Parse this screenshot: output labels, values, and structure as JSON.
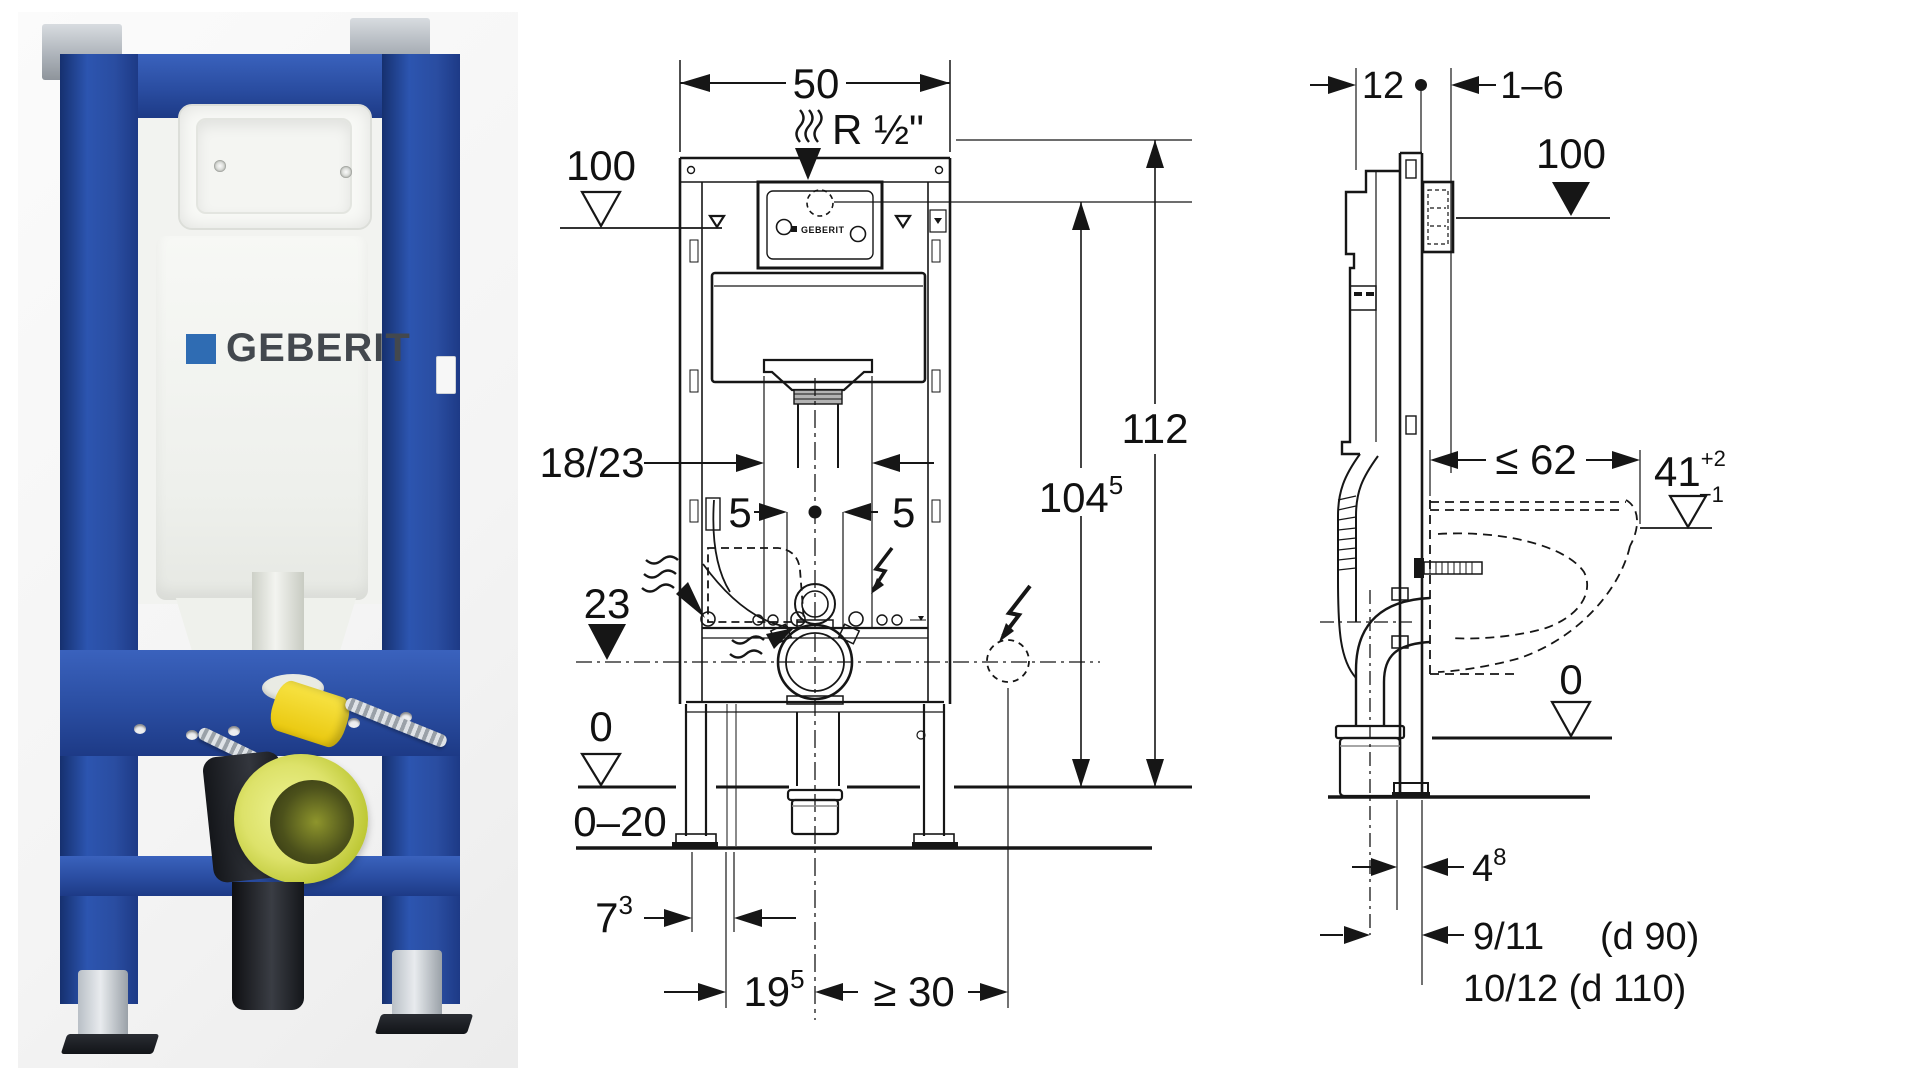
{
  "photo": {
    "brand": "GEBERIT",
    "frame_color": "#2a4da1",
    "cistern_color": "#f2f3f0",
    "drain_yellow": "#e8d832",
    "elbow_lime": "#d6de5e",
    "logo_blue": "#2f6cb3"
  },
  "front_view": {
    "top_width": "50",
    "supply": "R ½\"",
    "plate_level": "100",
    "height_total": "112",
    "actuation": {
      "base": "104",
      "sup": "5"
    },
    "bend": "18/23",
    "offset_left": "5",
    "offset_right": "5",
    "outlet_height": "23",
    "finished_floor": "0",
    "floor_buildup": "0–20",
    "dim73": {
      "base": "7",
      "sup": "3"
    },
    "dim195": {
      "base": "19",
      "sup": "5"
    },
    "clearance": "≥ 30",
    "plate_brand": "GEBERIT"
  },
  "side_view": {
    "frame_depth": "12",
    "wall_gap": "1–6",
    "plate_level": "100",
    "bowl_depth": "≤ 62",
    "rim": {
      "base": "41",
      "tol_plus": "+2",
      "tol_minus": "−1"
    },
    "finished_floor": "0",
    "screed": {
      "base": "4",
      "sup": "8"
    },
    "outlet90": {
      "value": "9/11",
      "note": "(d 90)"
    },
    "outlet110": "10/12 (d 110)"
  }
}
